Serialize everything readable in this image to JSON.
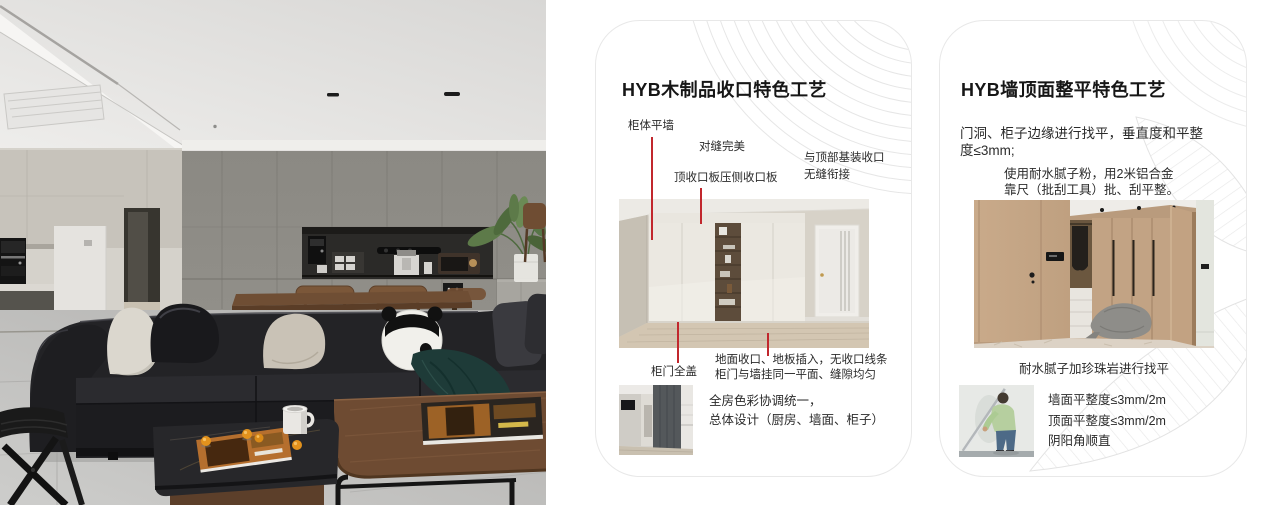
{
  "card1": {
    "title": "HYB木制品收口特色工艺",
    "callout_cabinet_wall": "柜体平墙",
    "callout_seam": "对缝完美",
    "callout_top_board": "顶收口板压侧收口板",
    "callout_top_joint1": "与顶部基装收口",
    "callout_top_joint2": "无缝衔接",
    "callout_door": "柜门全盖",
    "note1": "地面收口、地板插入，无收口线条",
    "note2": "柜门与墙挂同一平面、缝隙均匀",
    "summary1": "全房色彩协调统一，",
    "summary2": "总体设计（厨房、墙面、柜子）"
  },
  "card2": {
    "title": "HYB墙顶面整平特色工艺",
    "para1_1": "门洞、柜子边缘进行找平，垂直度和平整",
    "para1_2": "度≤3mm;",
    "para2_1": "使用耐水腻子粉，用2米铝合金",
    "para2_2": "靠尺（批刮工具）批、刮平整。",
    "caption": "耐水腻子加珍珠岩进行找平",
    "spec1": "墙面平整度≤3mm/2m",
    "spec2": "顶面平整度≤3mm/2m",
    "spec3": "阴阳角顺直"
  },
  "colors": {
    "accent_red": "#c1272d",
    "card_border": "#e8e8e8",
    "deco_line": "#e6e6e6"
  }
}
